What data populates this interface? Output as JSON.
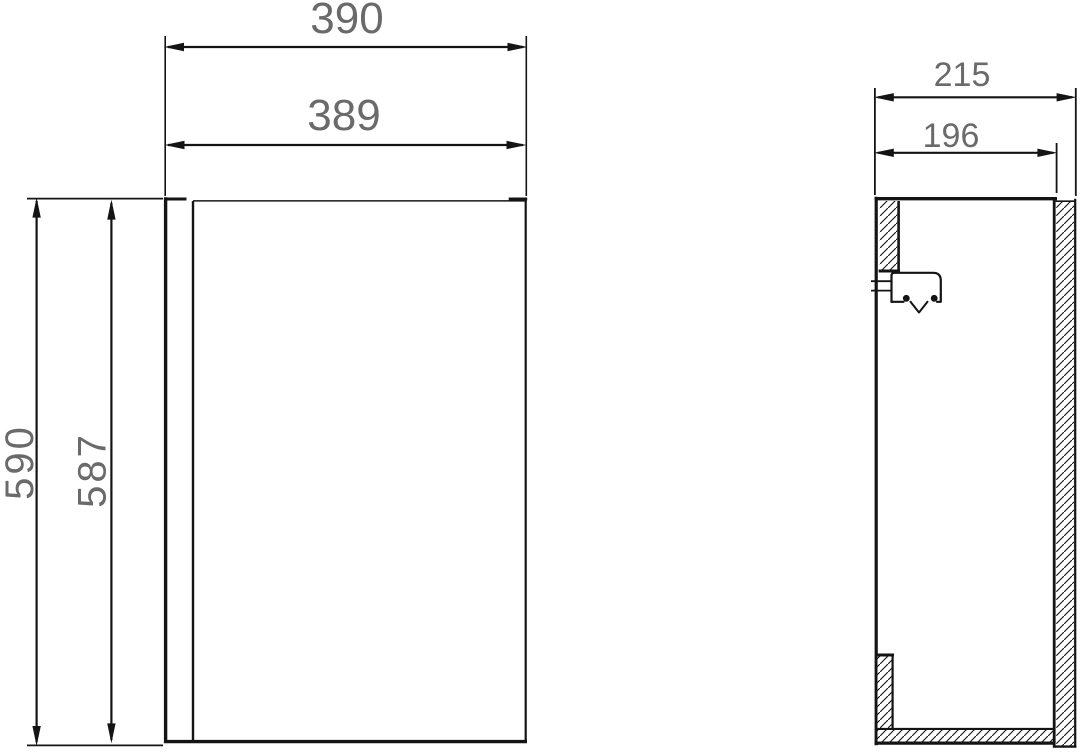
{
  "drawing": {
    "front_view": {
      "outer_width": "390",
      "door_width": "389",
      "outer_height": "590",
      "door_height": "587"
    },
    "side_view": {
      "outer_depth": "215",
      "inner_depth": "196"
    }
  },
  "colors": {
    "line": "#141414",
    "dimension_text": "#6a6a6a",
    "background": "#ffffff"
  }
}
